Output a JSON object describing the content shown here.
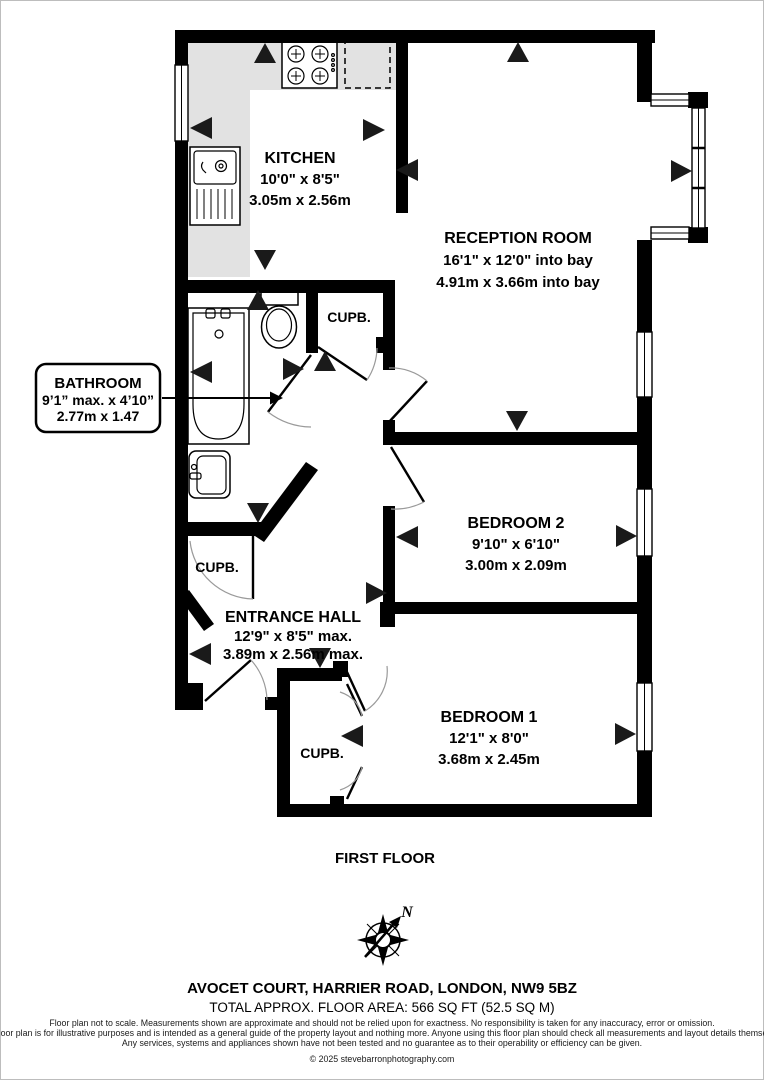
{
  "plan": {
    "floor_label": "FIRST FLOOR",
    "compass_north_label": "N",
    "cupboard_label": "CUPB.",
    "rooms": {
      "kitchen": {
        "name": "KITCHEN",
        "size_imperial": "10'0\" x 8'5\"",
        "size_metric": "3.05m x 2.56m"
      },
      "reception": {
        "name": "RECEPTION ROOM",
        "size_imperial": "16'1\" x 12'0\" into bay",
        "size_metric": "4.91m x 3.66m into bay"
      },
      "bedroom2": {
        "name": "BEDROOM 2",
        "size_imperial": "9'10\" x 6'10\"",
        "size_metric": "3.00m x 2.09m"
      },
      "entrance_hall": {
        "name": "ENTRANCE HALL",
        "size_imperial": "12'9\" x 8'5\" max.",
        "size_metric": "3.89m x 2.56m max."
      },
      "bedroom1": {
        "name": "BEDROOM 1",
        "size_imperial": "12'1\" x 8'0\"",
        "size_metric": "3.68m x 2.45m"
      }
    },
    "bathroom_callout": {
      "name": "BATHROOM",
      "size_imperial": "9’1” max. x 4’10”",
      "size_metric": "2.77m x 1.47"
    }
  },
  "footer": {
    "address": "AVOCET COURT, HARRIER ROAD, LONDON, NW9 5BZ",
    "floor_area": "TOTAL APPROX. FLOOR AREA: 566 SQ FT (52.5 SQ M)",
    "disclaimer": [
      "Floor plan not to scale. Measurements shown are approximate and should not be relied upon for exactness. No responsibility is taken for any inaccuracy, error or omission.",
      "The floor plan is for illustrative purposes and is intended as a general guide of the property layout and nothing more. Anyone using this floor plan should check all measurements and layout details themselves.",
      "Any services, systems and appliances shown have not been tested and no guarantee as to their operability or efficiency can be given."
    ],
    "copyright": "© 2025 stevebarronphotography.com"
  },
  "colors": {
    "wall": "#000000",
    "worktop": "#e2e2e2",
    "door_arc": "#9a9a9a",
    "background": "#ffffff"
  }
}
